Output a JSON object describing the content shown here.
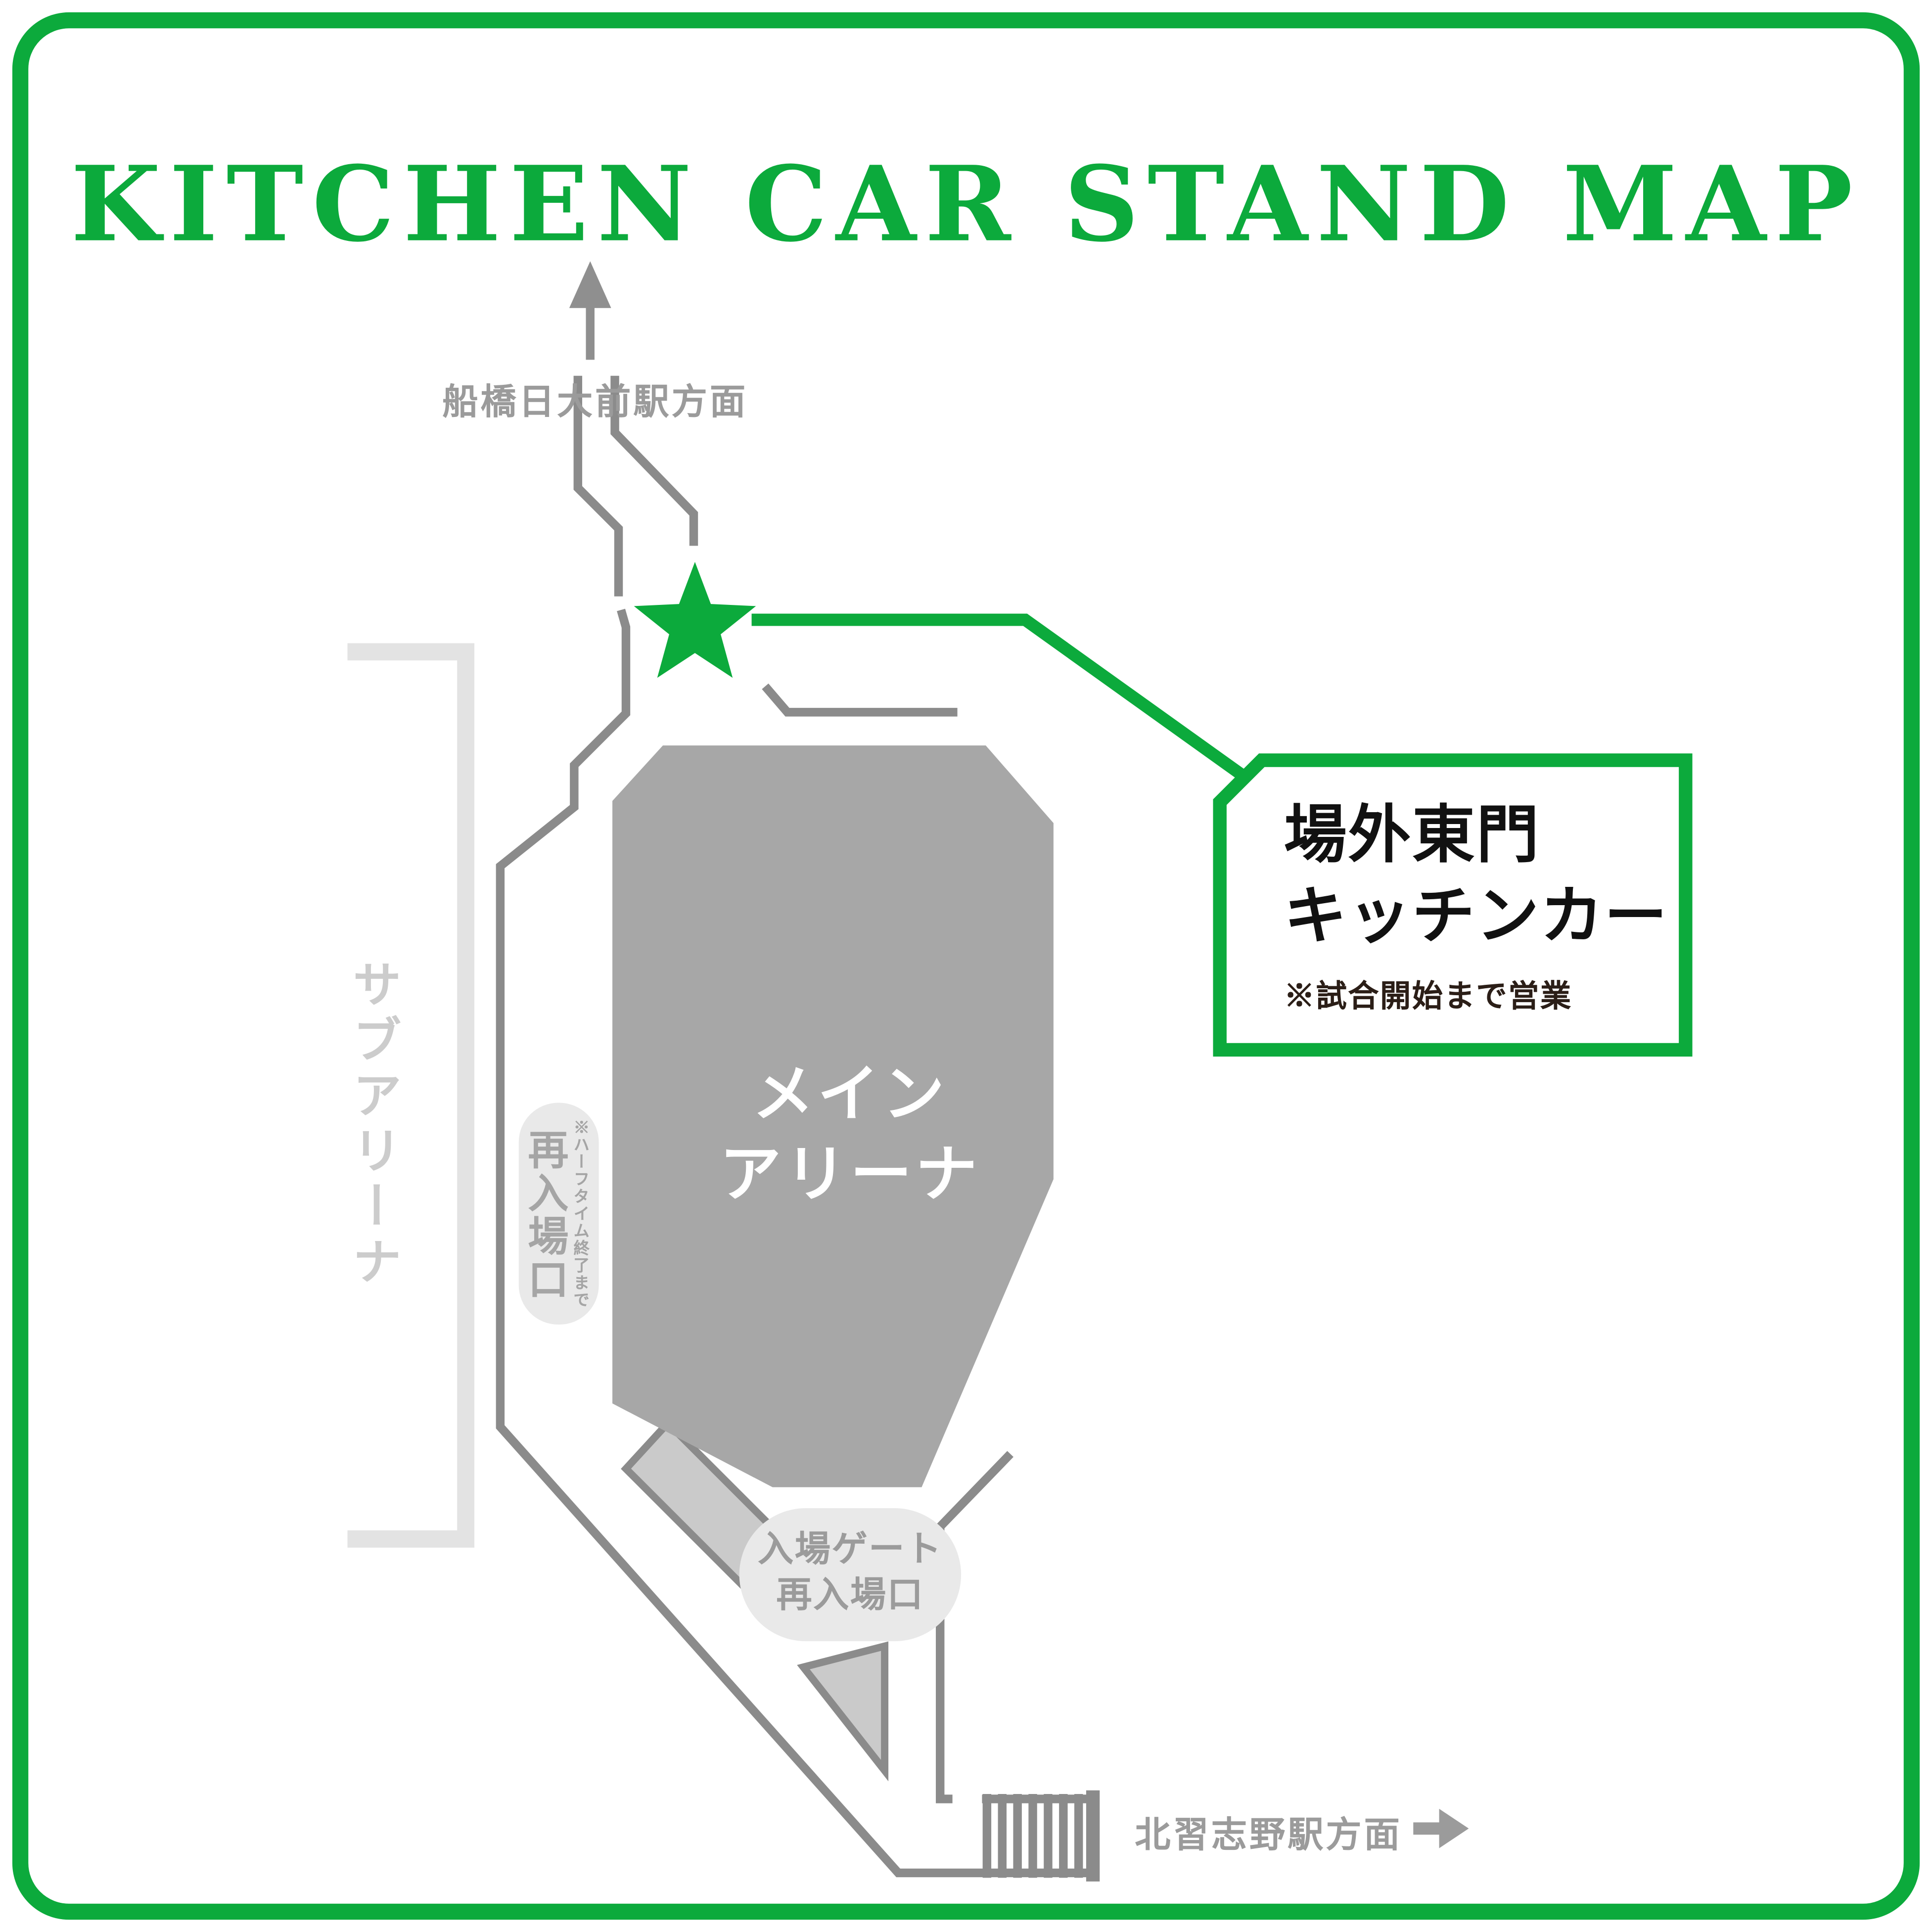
{
  "title": "KITCHEN CAR STAND MAP",
  "colors": {
    "accent_green": "#0CAA3C",
    "road_gray": "#8B8B8B",
    "arena_gray": "#A7A7A7",
    "pill_gray": "#E9E9E9",
    "walkway_gray": "#CACACA",
    "bracket_gray": "#E3E3E3",
    "label_gray": "#9B9B9B",
    "callout_text": "#111111",
    "callout_note_text": "#2B1E17"
  },
  "stations": {
    "north": "船橋日大前駅方面",
    "south": "北習志野駅方面"
  },
  "arena": {
    "main_line1": "メイン",
    "main_line2": "アリーナ",
    "sub": "サブアリーナ"
  },
  "gates": {
    "reentry": {
      "label": "再入場口",
      "note": "※ハーフタイム終了まで"
    },
    "entrance": {
      "line1": "入場ゲート",
      "line2": "再入場口"
    }
  },
  "callout": {
    "line1": "場外東門",
    "line2": "キッチンカー",
    "note": "※試合開始まで営業"
  },
  "icons": {
    "star": "kitchen-car-location-star",
    "up_arrow": "to-north-station-arrow",
    "right_arrow": "to-south-station-arrow",
    "stairs": "stairs"
  }
}
